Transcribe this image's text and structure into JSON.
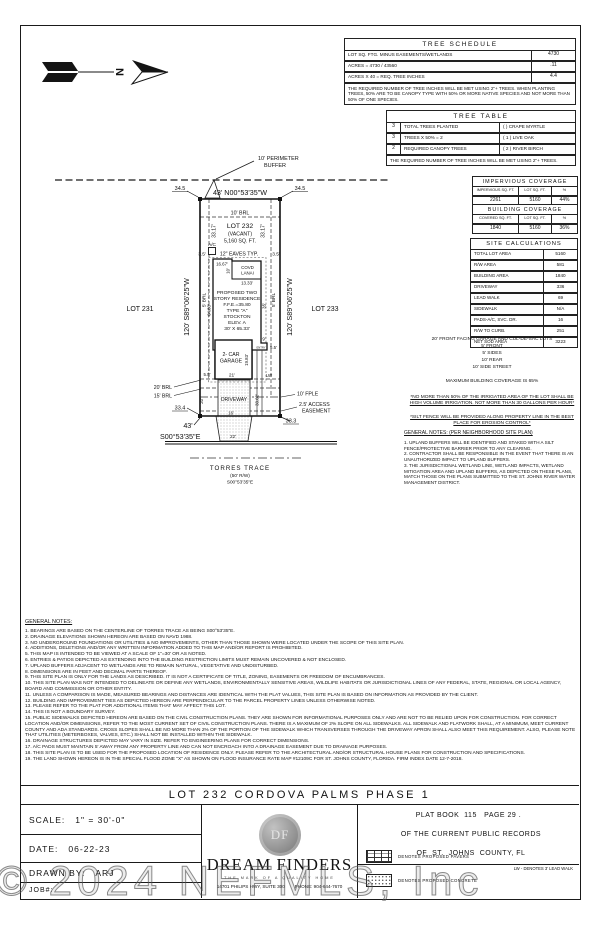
{
  "sheet": {
    "watermark": "© 2024 NEFMLS, Inc"
  },
  "plan": {
    "north_letter": "N",
    "perimeter_buffer_1": "10'  PERIMETER",
    "perimeter_buffer_2": "BUFFER",
    "dim_34_5": "34.5",
    "top_bearing": "43'  N00°53'35\"W",
    "side_bearing": "120'  S89°06'25\"W",
    "lot_left": "LOT 231",
    "lot_right": "LOT 233",
    "brl_top": "10'  BRL",
    "brl_side": "5' BRL",
    "dim_33_17": "33.17'",
    "lot_name": "LOT 232",
    "lot_status": "(VACANT)",
    "lot_area": "5,160 SQ. FT.",
    "ac": "A/C",
    "eave_dim": "3.5'",
    "eaves_note": "12\" EAVES  TYP.",
    "dim_16_67": "16.67'",
    "lanai_1": "COVD",
    "lanai_2": "LANAI",
    "dim_10": "10'",
    "dim_13_33": "13.33'",
    "house_1": "PROPOSED TWO",
    "house_2": "STORY RESIDENCE",
    "house_3": "F.F.E.=35.80",
    "house_4": "TYPE \"A\"",
    "house_5": "STOCKTON",
    "house_6": "ELEV.  A",
    "house_7": "30' X 65.33'",
    "dim_64_83": "64.83'",
    "dim_35": "35'",
    "garage_1": "2- CAR",
    "garage_2": "GARAGE",
    "dim_21": "21'",
    "dim_19_83": "19.83'",
    "entry": "ENTRY",
    "dim_9": "9'",
    "dim_5_5": "5.5'",
    "lw": "LW",
    "brl_20": "20' BRL",
    "brl_15": "15' BRL",
    "driveway": "DRIVEWAY",
    "dim_20": "20'",
    "dim_33_62": "33.62'",
    "dim_16": "16'",
    "fple": "10' FPLE",
    "access_1": "2.5' ACCESS",
    "access_2": "EASEMENT",
    "dim_33_4": "33.4",
    "dim_33_3": "33.3",
    "front_dim": "43'",
    "front_bearing": "S00°53'35\"E",
    "dim_22": "22'",
    "street_name": "TORRES TRACE",
    "street_rw": "(50' R/W)",
    "street_bearing": "S00°53'35\"E"
  },
  "tree_schedule": {
    "title": "TREE SCHEDULE",
    "rows": [
      {
        "label": "LOT SQ. FTG. MINUS EASEMENTS/WETLANDS",
        "value": "4730"
      },
      {
        "label": "ACRES =    4730 / 43560",
        "value": ".11"
      },
      {
        "label": "ACRES X 40 = REQ. TREE INCHES",
        "value": "4.4"
      }
    ],
    "note": "THE REQUIRED NUMBER OF TREE INCHES WILL BE MET USING 2\"+ TREES. WHEN PLANTING TREES, 50% ARE TO BE CANOPY TYPE WITH 50% OR MORE NATIVE SPECIES AND NOT MORE THAN 50% OF ONE SPECIES.",
    "chart_data": {
      "type": "table",
      "title": "TREE SCHEDULE",
      "rows": [
        [
          "LOT SQ. FTG. MINUS EASEMENTS/WETLANDS",
          "4730"
        ],
        [
          "ACRES = 4730 / 43560",
          ".11"
        ],
        [
          "ACRES X 40 = REQ. TREE INCHES",
          "4.4"
        ]
      ]
    }
  },
  "tree_table": {
    "title": "TREE TABLE",
    "rows": [
      {
        "qty": "3",
        "label": "TOTAL TREES PLANTED",
        "species": "(    ) CRAPE MYRTLE"
      },
      {
        "qty": "3",
        "label": "TREES X 50% =    2",
        "species": "( 1 ) LIVE OAK"
      },
      {
        "qty": "2",
        "label": "REQUIRED CANOPY TREES",
        "species": "( 2 ) RIVER BIRCH"
      }
    ],
    "note": "THE REQUIRED NUMBER OF TREE INCHES WILL BE MET USING 2\"+ TREES."
  },
  "impervious_coverage": {
    "title": "IMPERVIOUS COVERAGE",
    "headers": [
      "IMPERVIOUS SQ. FT.",
      "LOT SQ. FT.",
      "%"
    ],
    "values": [
      "2261",
      "5160",
      "44%"
    ]
  },
  "building_coverage": {
    "title": "BUILDING COVERAGE",
    "headers": [
      "COVERED SQ. FT.",
      "LOT SQ. FT.",
      "%"
    ],
    "values": [
      "1840",
      "5160",
      "36%"
    ]
  },
  "site_calculations": {
    "title": "SITE CALCULATIONS",
    "rows": [
      {
        "label": "TOTAL LOT AREA",
        "value": "5160"
      },
      {
        "label": "R/W AREA",
        "value": "581"
      },
      {
        "label": "BUILDING AREA",
        "value": "1840"
      },
      {
        "label": "DRIVEWAY",
        "value": "336"
      },
      {
        "label": "LEAD WALK",
        "value": "69"
      },
      {
        "label": "SIDEWALK",
        "value": "N/A"
      },
      {
        "label": "PADS-A/C, SVC. DR.",
        "value": "16"
      },
      {
        "label": "R/W TO CURB.",
        "value": "251"
      },
      {
        "label": "NET SOD AREA",
        "value": "3223"
      }
    ]
  },
  "setback_notes": {
    "header": "20' FRONT FACING GARAGE AND CUL-DE-SAC LOTS",
    "sb1": "5' FRONT",
    "sb2": "5' SIDES",
    "sb3": "10' REAR",
    "sb4": "10' SIDE STREET",
    "max_coverage": "MAXIMUM BUILDING COVERAGE IS 65%",
    "irrigation": "*NO MORE THAN 50% OF THE IRRIGATED AREA OF THE LOT SHALL BE HIGH VOLUME IRRIGATION. NOT MORE THAN 30 GALLONS PER HOUR*",
    "silt_fence": "*SILT FENCE WILL BE PROVIDED ALONG PROPERTY LINE IN THE BEST PLACE FOR EROSION CONTROL*"
  },
  "neighborhood_notes": {
    "title": "GENERAL NOTES: (PER NEIGHBORHOOD SITE PLAN)",
    "body": "1. UPLAND BUFFERS WILL BE IDENTIFIED AND STAKED WITH A SILT FENCE/PROTECTIVE BARRIER PRIOR TO ANY CLEARING.\n2. CONTRACTOR SHALL BE RESPONSIBLE IN THE EVENT THAT THERE IS AN UNAUTHORIZED IMPACT TO UPLAND BUFFERS.\n3. THE JURISDICTIONAL WETLAND LINE, WETLAND IMPACTS, WETLAND MITIGATION AREA AND UPLAND BUFFERS, AS DEPICTED ON THESE PLANS, MATCH THOSE ON THE PLANS SUBMITTED TO THE ST. JOHNS RIVER WATER MANAGEMENT DISTRICT."
  },
  "general_notes": {
    "title": "GENERAL NOTES:",
    "lines": [
      "1. BEARINGS ARE BASED ON THE CENTERLINE OF TORRES TRACE AS BEING S00°53'35\"E.",
      "2. DRAINAGE ELEVATIONS SHOWN HEREON ARE BASED ON NAVD 1988.",
      "3. NO UNDERGROUND FOUNDATIONS OR UTILITIES & NO IMPROVEMENTS, OTHER THAN THOSE SHOWN WERE LOCATED UNDER THE SCOPE OF THIS SITE PLAN.",
      "4. ADDITIONS, DELETIONS AND/OR ANY WRITTEN INFORMATION ADDED TO THIS MAP AND/OR REPORT IS PROHIBITED.",
      "5. THIS MAP IS INTENDED TO BE VIEWED AT A SCALE OF 1\"=30' OR AS NOTED.",
      "6. ENTRIES & PATIOS DEPICTED AS EXTENDING INTO THE BUILDING RESTRICTION LIMITS MUST REMAIN UNCOVERED & NOT ENCLOSED.",
      "7. UPLAND BUFFERS ADJACENT TO WETLANDS ARE TO REMAIN NATURAL, VEGETATIVE AND UNDISTURBED.",
      "8. DIMENSIONS ARE IN FEET AND DECIMAL PARTS THEREOF.",
      "9. THIS SITE PLAN IS ONLY FOR THE LANDS AS DESCRIBED. IT IS NOT A CERTIFICATE OF TITLE, ZONING, EASEMENTS OR FREEDOM OF ENCUMBRANCES.",
      "10. THIS SITE PLAN WAS NOT INTENDED TO DELINEATE OR DEFINE ANY WETLANDS, ENVIRONMENTALLY SENSITIVE AREAS, WILDLIFE HABITATS OR JURISDICTIONAL LINES OF ANY FEDERAL, STATE, REGIONAL OR LOCAL AGENCY, BOARD AND COMMISSION OR OTHER ENTITY.",
      "11. UNLESS A COMPARISON IS MADE, MEASURED BEARINGS AND DISTANCES ARE IDENTICAL WITH THE PLAT VALUES, THIS SITE PLAN IS BASED ON INFORMATION AS PROVIDED BY THE CLIENT.",
      "12. BUILDING AND IMPROVEMENT TIES AS DEPICTED HEREON ARE PERPENDICULAR TO THE PARCEL PROPERTY LINES UNLESS OTHERWISE NOTED.",
      "13. PLEASE REFER TO THE PLAT FOR ADDITIONAL ITEMS THAT MAY AFFECT THIS LOT.",
      "14. THIS IS NOT A BOUNDARY SURVEY.",
      "15. PUBLIC SIDEWALKS DEPICTED HEREON ARE BASED ON THE CIVIL CONSTRUCTION PLANS. THEY ARE SHOWN FOR INFORMATIONAL PURPOSES ONLY AND ARE NOT TO BE RELIED UPON FOR CONSTRUCTION. FOR CORRECT LOCATION AND/OR DIMENSIONS, REFER TO THE MOST CURRENT SET OF CIVIL CONSTRUCTION PLANS. THERE IS A MAXIMUM OF 2% SLOPE ON ALL SIDEWALKS. ALL SIDEWALK AND FLATWORK SHALL, AT A MINIMUM, MEET CURRENT COUNTY AND ADA STANDARDS. CROSS SLOPES SHALL BE NO MORE THAN 2% OF THE PORTION OF THE SIDEWALK WHICH TRANSVERSES THROUGH THE DRIVEWAY APRON SHALL ALSO MEET THIS REQUIREMENT. ALSO, PLEASE NOTE THAT UTILITIES (METERBOXES, VALVES, ETC.) SHALL NOT BE INSTALLED WITHIN THE SIDEWALK.",
      "16. DRAINAGE STRUCTURES DEPICTED MAY VARY IN SIZE. REFER TO ENGINEERING PLANS FOR CORRECT DIMENSIONS.",
      "17. A/C PADS MUST MAINTAIN 5' AWAY FROM ANY PROPERTY LINE AND CAN NOT ENCROACH INTO A DRAINAGE EASEMENT DUE TO DRAINAGE PURPOSES.",
      "18. THIS SITE PLAN IS TO BE USED FOR THE PROPOSED LOCATION OF RESIDENCE ONLY. PLEASE REFER TO THE ARCHITECTURAL AND/OR STRUCTURAL HOUSE PLANS FOR CONSTRUCTION AND SPECIFICATIONS.",
      "19. THE LAND SHOWN HEREON IS IN THE SPECIAL FLOOD ZONE \"X\" AS SHOWN ON FLOOD INSURANCE RATE MAP #12109C FOR ST. JOHNS COUNTY, FLORIDA. FIRM INDEX DATE 12-7-2018."
    ]
  },
  "title_block": {
    "title": "LOT 232 CORDOVA PALMS PHASE 1",
    "scale_label": "SCALE:",
    "scale_value": "1\" = 30'-0\"",
    "date_label": "DATE:",
    "date_value": "06-22-23",
    "drawn_label": "DRAWN BY:",
    "drawn_value": "ARJ",
    "job_label": "JOB#:",
    "seal_monogram": "DF",
    "brand": "DREAM FINDERS",
    "tagline": "THE MARK OF A QUALITY HOME",
    "address": "14701 PHILIPS HWY, SUITE 300",
    "phone": "PHONE: 904-644-7670",
    "plat_1": "PLAT BOOK  115   PAGE 29 .",
    "plat_2": "OF THE CURRENT PUBLIC RECORDS",
    "plat_3": "OF  ST.  JOHNS  COUNTY, FL",
    "legend_pavers": "DENOTES PROPOSED PAVERS",
    "legend_concrete": "DENOTES PROPOSED CONCRETE",
    "legend_lw": "LW - DENOTES 3' LEAD WALK"
  }
}
